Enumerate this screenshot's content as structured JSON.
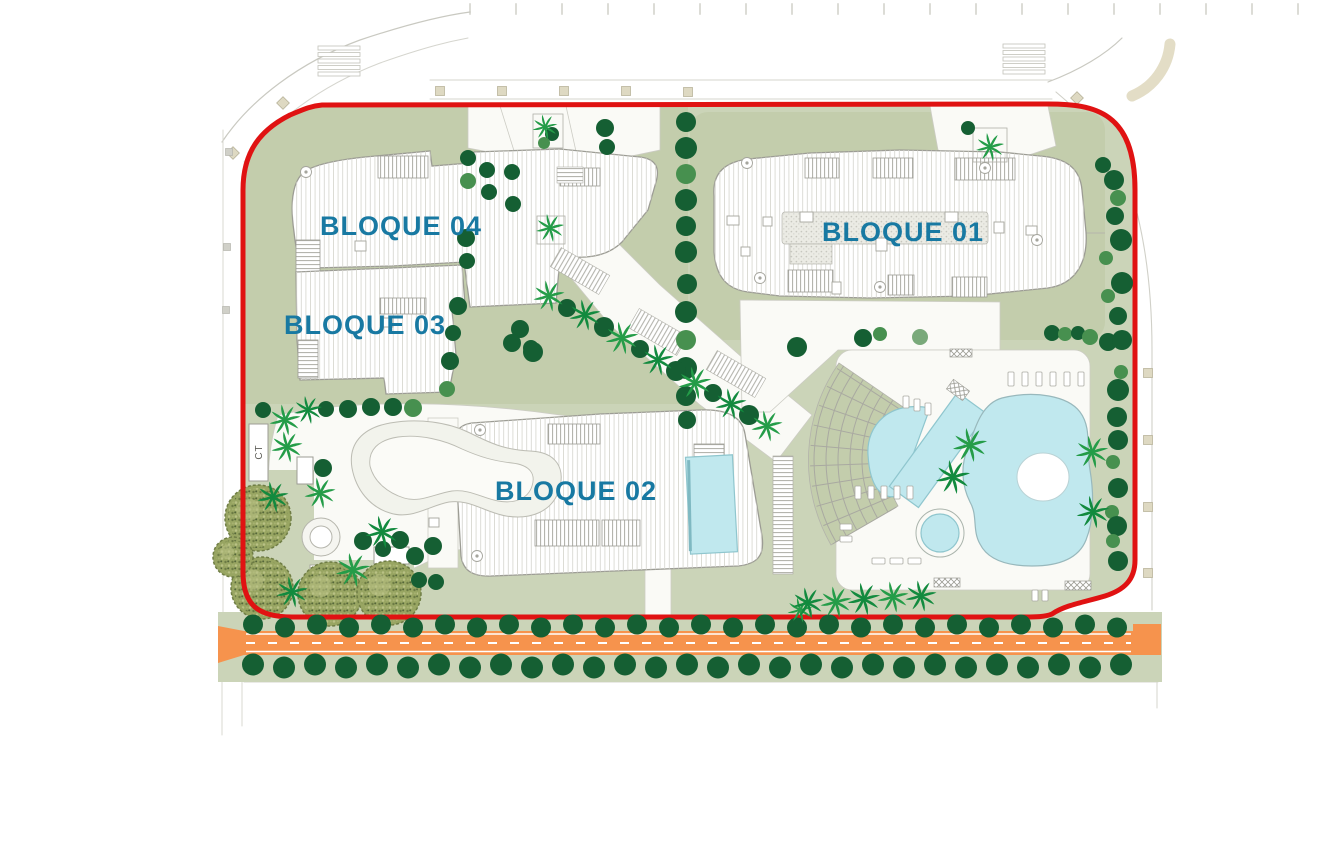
{
  "labels": {
    "bloque01": "BLOQUE 01",
    "bloque02": "BLOQUE 02",
    "bloque03": "BLOQUE 03",
    "bloque04": "BLOQUE 04",
    "ct": "CT"
  },
  "colors": {
    "label_teal": "#1879a2",
    "boundary_red": "#e01212",
    "ground_sage": "#cbd4b8",
    "ground_sage_dark": "#c3cdac",
    "plaza_white": "#fafaf6",
    "building_fill": "#ffffff",
    "building_outline": "#9c9c94",
    "deck_line": "#d9d9d2",
    "pool_blue": "#c0e8ee",
    "pool_edge": "#8fc6ce",
    "road_orange": "#f6934d",
    "road_marking": "#ffffff",
    "tree_dark": "#155f33",
    "tree_mid": "#47904f",
    "tree_light": "#79a97a",
    "palm_green": "#249c48",
    "palm_dark": "#128a3e",
    "canopy_olive": "#98a562",
    "canopy_edge": "#6f7d45",
    "context_gray": "#c9c9c1",
    "beige": "#ded9c2"
  },
  "plan": {
    "round_trees": [
      [
        686,
        122,
        10,
        0
      ],
      [
        686,
        148,
        11,
        0
      ],
      [
        686,
        174,
        10,
        1
      ],
      [
        686,
        200,
        11,
        0
      ],
      [
        686,
        226,
        10,
        0
      ],
      [
        686,
        252,
        11,
        0
      ],
      [
        687,
        284,
        10,
        0
      ],
      [
        686,
        312,
        11,
        0
      ],
      [
        686,
        340,
        10,
        1
      ],
      [
        686,
        368,
        11,
        0
      ],
      [
        686,
        396,
        10,
        0
      ],
      [
        687,
        420,
        9,
        0
      ],
      [
        468,
        158,
        8,
        0
      ],
      [
        468,
        181,
        8,
        1
      ],
      [
        466,
        238,
        9,
        0
      ],
      [
        467,
        261,
        8,
        0
      ],
      [
        458,
        306,
        9,
        0
      ],
      [
        453,
        333,
        8,
        0
      ],
      [
        450,
        361,
        9,
        0
      ],
      [
        447,
        389,
        8,
        1
      ],
      [
        487,
        170,
        8,
        0
      ],
      [
        489,
        192,
        8,
        0
      ],
      [
        520,
        329,
        9,
        0
      ],
      [
        531,
        348,
        8,
        0
      ],
      [
        512,
        172,
        8,
        0
      ],
      [
        513,
        204,
        8,
        0
      ],
      [
        552,
        134,
        7,
        0
      ],
      [
        544,
        143,
        6,
        1
      ],
      [
        605,
        128,
        9,
        0
      ],
      [
        607,
        147,
        8,
        0
      ],
      [
        567,
        308,
        9,
        0
      ],
      [
        604,
        327,
        10,
        0
      ],
      [
        640,
        349,
        9,
        0
      ],
      [
        676,
        371,
        10,
        0
      ],
      [
        713,
        393,
        9,
        0
      ],
      [
        749,
        415,
        10,
        0
      ],
      [
        512,
        343,
        9,
        0
      ],
      [
        533,
        352,
        10,
        0
      ],
      [
        797,
        347,
        10,
        0
      ],
      [
        863,
        338,
        9,
        0
      ],
      [
        880,
        334,
        7,
        1
      ],
      [
        920,
        337,
        8,
        2
      ],
      [
        1052,
        333,
        8,
        0
      ],
      [
        1065,
        334,
        7,
        1
      ],
      [
        1078,
        333,
        7,
        0
      ],
      [
        1090,
        337,
        8,
        1
      ],
      [
        1108,
        342,
        9,
        0
      ],
      [
        968,
        128,
        7,
        0
      ],
      [
        1103,
        165,
        8,
        0
      ],
      [
        1114,
        180,
        10,
        0
      ],
      [
        1118,
        198,
        8,
        1
      ],
      [
        1115,
        216,
        9,
        0
      ],
      [
        1121,
        240,
        11,
        0
      ],
      [
        1106,
        258,
        7,
        1
      ],
      [
        1122,
        283,
        11,
        0
      ],
      [
        1108,
        296,
        7,
        1
      ],
      [
        1118,
        316,
        9,
        0
      ],
      [
        1122,
        340,
        10,
        0
      ],
      [
        1121,
        372,
        7,
        1
      ],
      [
        1118,
        390,
        11,
        0
      ],
      [
        1117,
        417,
        10,
        0
      ],
      [
        1118,
        440,
        10,
        0
      ],
      [
        1113,
        462,
        7,
        1
      ],
      [
        1118,
        488,
        10,
        0
      ],
      [
        1112,
        512,
        7,
        1
      ],
      [
        1117,
        526,
        10,
        0
      ],
      [
        1113,
        541,
        7,
        1
      ],
      [
        1118,
        561,
        10,
        0
      ],
      [
        263,
        410,
        8,
        0
      ],
      [
        323,
        468,
        9,
        0
      ],
      [
        363,
        541,
        9,
        0
      ],
      [
        383,
        549,
        8,
        0
      ],
      [
        400,
        540,
        9,
        0
      ],
      [
        415,
        556,
        9,
        0
      ],
      [
        433,
        546,
        9,
        0
      ],
      [
        419,
        580,
        8,
        0
      ],
      [
        436,
        582,
        8,
        0
      ],
      [
        326,
        409,
        8,
        0
      ],
      [
        348,
        409,
        9,
        0
      ],
      [
        371,
        407,
        9,
        0
      ],
      [
        393,
        407,
        9,
        0
      ],
      [
        413,
        408,
        9,
        1
      ]
    ],
    "palm_trees": [
      [
        545,
        127,
        0.8,
        0
      ],
      [
        550,
        228,
        0.9,
        0
      ],
      [
        990,
        147,
        0.9,
        0
      ],
      [
        549,
        296,
        1.0,
        0
      ],
      [
        585,
        315,
        1.0,
        1
      ],
      [
        622,
        338,
        1.05,
        0
      ],
      [
        658,
        360,
        1.0,
        1
      ],
      [
        695,
        383,
        1.05,
        0
      ],
      [
        731,
        404,
        1.0,
        1
      ],
      [
        767,
        426,
        1.0,
        0
      ],
      [
        285,
        420,
        1.0,
        0
      ],
      [
        308,
        410,
        0.9,
        1
      ],
      [
        287,
        447,
        1.0,
        0
      ],
      [
        273,
        497,
        1.0,
        1
      ],
      [
        320,
        493,
        1.0,
        0
      ],
      [
        382,
        532,
        1.05,
        1
      ],
      [
        353,
        570,
        1.1,
        0
      ],
      [
        292,
        592,
        1.0,
        1
      ],
      [
        970,
        445,
        1.1,
        0
      ],
      [
        953,
        477,
        1.1,
        1
      ],
      [
        1092,
        452,
        1.05,
        0
      ],
      [
        1093,
        512,
        1.05,
        1
      ],
      [
        800,
        610,
        0.8,
        0
      ],
      [
        808,
        603,
        1.0,
        1
      ],
      [
        836,
        602,
        1.0,
        0
      ],
      [
        864,
        599,
        1.05,
        1
      ],
      [
        893,
        597,
        1.0,
        0
      ],
      [
        921,
        596,
        1.0,
        1
      ]
    ],
    "canopy_trees": [
      [
        258,
        518,
        33
      ],
      [
        262,
        588,
        31
      ],
      [
        330,
        594,
        32
      ],
      [
        389,
        593,
        32
      ],
      [
        233,
        557,
        20
      ]
    ],
    "road_tree_rows": [
      {
        "y": 626,
        "x0": 253,
        "x1": 1124,
        "step": 32,
        "r": 10
      },
      {
        "y": 666,
        "x0": 253,
        "x1": 1150,
        "step": 31,
        "r": 11
      }
    ],
    "beige_squares": [
      [
        440,
        91,
        0
      ],
      [
        502,
        91,
        0
      ],
      [
        564,
        91,
        0
      ],
      [
        626,
        91,
        0
      ],
      [
        688,
        92,
        0
      ],
      [
        283,
        103,
        45
      ],
      [
        233,
        153,
        45
      ],
      [
        1077,
        98,
        45
      ],
      [
        1125,
        147,
        45
      ],
      [
        1148,
        373,
        0
      ],
      [
        1148,
        440,
        0
      ],
      [
        1148,
        507,
        0
      ],
      [
        1148,
        573,
        0
      ]
    ],
    "gray_squares": [
      [
        229,
        152
      ],
      [
        227,
        247
      ],
      [
        226,
        310
      ]
    ],
    "crosswalks": [
      [
        318,
        46
      ],
      [
        1003,
        44
      ]
    ],
    "loungers": [
      [
        1008,
        372,
        6,
        14
      ],
      [
        1022,
        372,
        6,
        14
      ],
      [
        1036,
        372,
        6,
        14
      ],
      [
        1050,
        372,
        6,
        14
      ],
      [
        1064,
        372,
        6,
        14
      ],
      [
        1078,
        372,
        6,
        14
      ],
      [
        855,
        486,
        6,
        13
      ],
      [
        868,
        486,
        6,
        13
      ],
      [
        881,
        486,
        6,
        13
      ],
      [
        894,
        486,
        6,
        13
      ],
      [
        907,
        486,
        6,
        13
      ],
      [
        872,
        558,
        13,
        6
      ],
      [
        890,
        558,
        13,
        6
      ],
      [
        908,
        558,
        13,
        6
      ],
      [
        840,
        524,
        12,
        6
      ],
      [
        840,
        536,
        12,
        6
      ],
      [
        903,
        396,
        6,
        12
      ],
      [
        914,
        399,
        6,
        12
      ],
      [
        925,
        403,
        6,
        12
      ],
      [
        1032,
        590,
        6,
        11
      ],
      [
        1042,
        590,
        6,
        11
      ]
    ],
    "hatch_boxes": [
      [
        950,
        349,
        22,
        8
      ],
      [
        934,
        578,
        26,
        9
      ],
      [
        1065,
        581,
        26,
        9
      ]
    ],
    "small_squares": [
      [
        800,
        212,
        13,
        10
      ],
      [
        876,
        238,
        11,
        13
      ],
      [
        945,
        212,
        13,
        10
      ],
      [
        1026,
        226,
        11,
        9
      ],
      [
        727,
        216,
        12,
        9
      ],
      [
        763,
        217,
        9,
        9
      ],
      [
        994,
        222,
        10,
        11
      ],
      [
        832,
        282,
        9,
        12
      ],
      [
        741,
        247,
        9,
        9
      ],
      [
        355,
        241,
        11,
        10
      ],
      [
        383,
        318,
        10,
        9
      ],
      [
        429,
        518,
        10,
        9
      ],
      [
        310,
        565,
        9,
        9
      ]
    ],
    "spirals": [
      [
        747,
        163
      ],
      [
        985,
        168
      ],
      [
        760,
        278
      ],
      [
        880,
        287
      ],
      [
        1037,
        240
      ],
      [
        306,
        172
      ],
      [
        480,
        430
      ],
      [
        477,
        556
      ]
    ],
    "white_rects": [
      [
        297,
        457,
        16,
        27
      ],
      [
        374,
        547,
        35,
        17
      ]
    ]
  }
}
